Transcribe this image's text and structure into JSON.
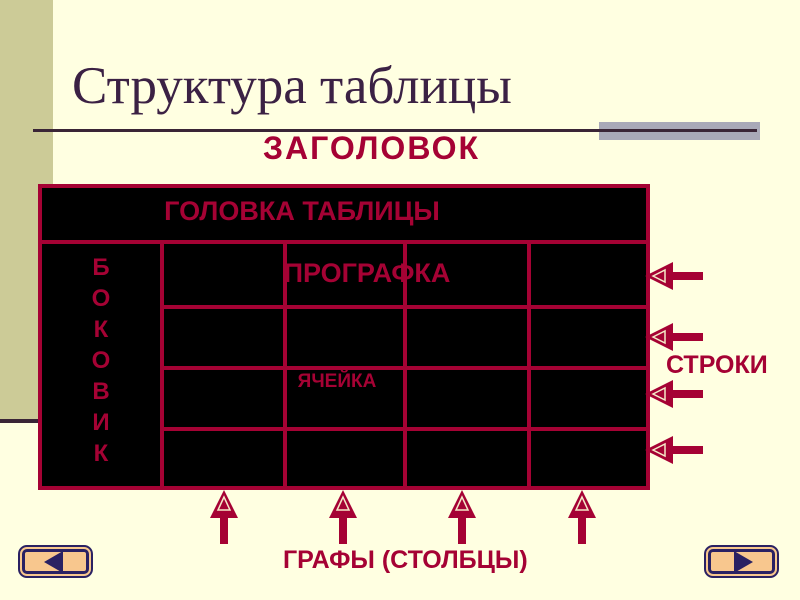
{
  "title": "Структура таблицы",
  "labels": {
    "header": "ЗАГОЛОВОК",
    "table_head": "ГОЛОВКА ТАБЛИЦЫ",
    "sidebar_vertical": "БОКОВИК",
    "prografka": "ПРОГРАФКА",
    "cell": "ЯЧЕЙКА",
    "rows": "СТРОКИ",
    "columns": "ГРАФЫ (СТОЛБЦЫ)"
  },
  "diagram": {
    "row_arrow_count": 4,
    "column_arrow_count": 4,
    "row_arrow_icon": "arrow-left-icon",
    "column_arrow_icon": "arrow-up-icon"
  },
  "nav": {
    "back_icon": "triangle-left-icon",
    "forward_icon": "triangle-right-icon"
  },
  "colors": {
    "background": "#FFFFE1",
    "sidebar": "#CCCB97",
    "accent_red": "#A50234",
    "table_bg": "#000000",
    "title_text": "#3B2144",
    "rule_line": "#3A2536",
    "rule_block": "#A9A9B8",
    "button_fill": "#F8C78E",
    "button_border": "#2A2163"
  }
}
